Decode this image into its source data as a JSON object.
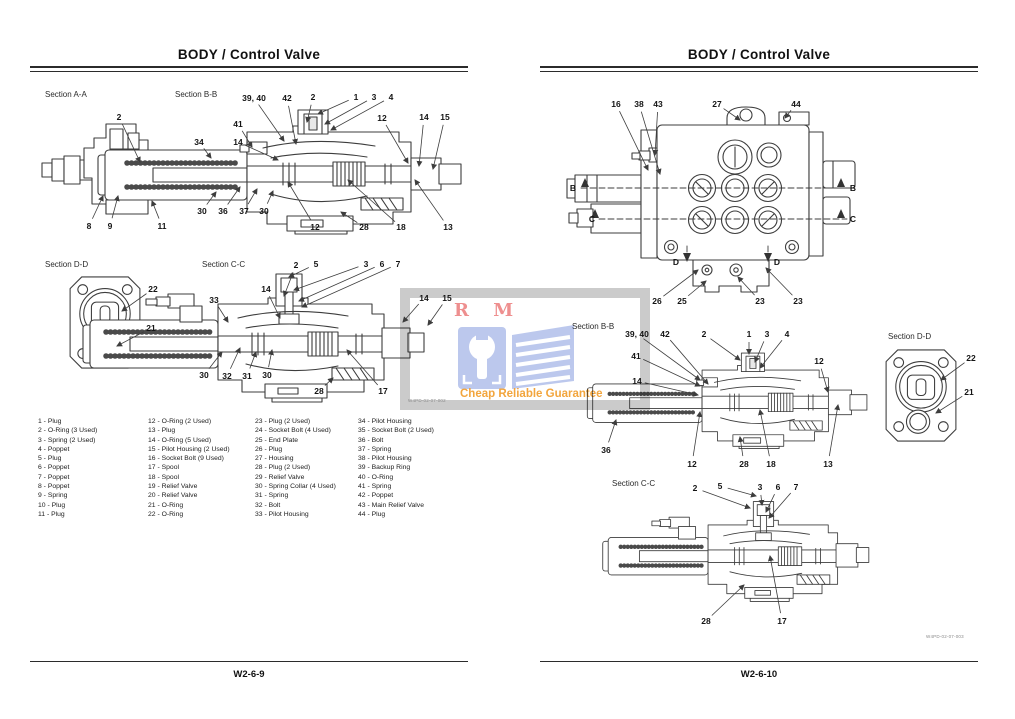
{
  "left_page": {
    "title": "BODY / Control Valve",
    "page_number": "W2-6-9",
    "drawing_number": "W4PD-02-07-002"
  },
  "right_page": {
    "title": "BODY / Control Valve",
    "page_number": "W2-6-10",
    "drawing_number": "W4PD-02-07-003"
  },
  "watermark": {
    "brand": "R M",
    "tagline": "Cheap Reliable Guarantee",
    "colors": {
      "brand_red": "#ee8f8f",
      "logo_blue": "#bcc8ed",
      "tagline_orange": "#f2a53d",
      "frame_gray": "#cbcbcb"
    }
  },
  "parts_list": {
    "columns": [
      [
        "1 - Plug",
        "2 - O-Ring (3 Used)",
        "3 - Spring (2 Used)",
        "4 - Poppet",
        "5 - Plug",
        "6 - Poppet",
        "7 - Poppet",
        "8 - Poppet",
        "9 - Spring",
        "10 - Plug",
        "11 - Plug"
      ],
      [
        "12 - O-Ring (2 Used)",
        "13 - Plug",
        "14 - O-Ring (5 Used)",
        "15 - Pilot Housing (2 Used)",
        "16 - Socket Bolt (9 Used)",
        "17 - Spool",
        "18 - Spool",
        "19 - Relief Valve",
        "20 - Relief Valve",
        "21 - O-Ring",
        "22 - O-Ring"
      ],
      [
        "23 - Plug (2 Used)",
        "24 - Socket Bolt (4 Used)",
        "25 - End Plate",
        "26 - Plug",
        "27 - Housing",
        "28 - Plug (2 Used)",
        "29 - Relief Valve",
        "30 - Spring Collar (4 Used)",
        "31 - Spring",
        "32 - Bolt",
        "33 - Pilot Housing"
      ],
      [
        "34 - Pilot Housing",
        "35 - Socket Bolt (2 Used)",
        "36 - Bolt",
        "37 - Spring",
        "38 - Pilot Housing",
        "39 - Backup Ring",
        "40 - O-Ring",
        "41 - Spring",
        "42 - Poppet",
        "43 - Main Relief Valve",
        "44 - Plug"
      ]
    ]
  },
  "diagrams": [
    {
      "name": "section-aa-left",
      "label": "Section A-A",
      "label_x": 45,
      "label_y": 90,
      "callouts": [
        {
          "t": "2",
          "x": 119,
          "y": 117,
          "lx": 140,
          "ly": 162
        },
        {
          "t": "8",
          "x": 89,
          "y": 226,
          "lx": 103,
          "ly": 196
        },
        {
          "t": "9",
          "x": 110,
          "y": 226,
          "lx": 118,
          "ly": 196
        },
        {
          "t": "11",
          "x": 162,
          "y": 226,
          "lx": 152,
          "ly": 201
        }
      ]
    },
    {
      "name": "section-bb-left",
      "label": "Section B-B",
      "label_x": 175,
      "label_y": 90,
      "callouts": [
        {
          "t": "39, 40",
          "x": 254,
          "y": 98,
          "lx": 284,
          "ly": 141
        },
        {
          "t": "42",
          "x": 287,
          "y": 98,
          "lx": 296,
          "ly": 144
        },
        {
          "t": "2",
          "x": 313,
          "y": 97,
          "lx": 307,
          "ly": 122
        },
        {
          "t": "1",
          "x": 356,
          "y": 97,
          "lx": 318,
          "ly": 114
        },
        {
          "t": "3",
          "x": 374,
          "y": 97,
          "lx": 325,
          "ly": 124
        },
        {
          "t": "4",
          "x": 391,
          "y": 97,
          "lx": 331,
          "ly": 130
        },
        {
          "t": "12",
          "x": 382,
          "y": 118,
          "lx": 408,
          "ly": 163
        },
        {
          "t": "14",
          "x": 424,
          "y": 117,
          "lx": 419,
          "ly": 166
        },
        {
          "t": "15",
          "x": 445,
          "y": 117,
          "lx": 433,
          "ly": 169
        },
        {
          "t": "41",
          "x": 238,
          "y": 124,
          "lx": 252,
          "ly": 147
        },
        {
          "t": "34",
          "x": 199,
          "y": 142,
          "lx": 211,
          "ly": 158
        },
        {
          "t": "14",
          "x": 238,
          "y": 142,
          "lx": 278,
          "ly": 160
        },
        {
          "t": "30",
          "x": 202,
          "y": 211,
          "lx": 216,
          "ly": 192
        },
        {
          "t": "36",
          "x": 223,
          "y": 211,
          "lx": 240,
          "ly": 187
        },
        {
          "t": "37",
          "x": 244,
          "y": 211,
          "lx": 257,
          "ly": 189
        },
        {
          "t": "30",
          "x": 264,
          "y": 211,
          "lx": 273,
          "ly": 191
        },
        {
          "t": "12",
          "x": 315,
          "y": 227,
          "lx": 288,
          "ly": 182
        },
        {
          "t": "28",
          "x": 364,
          "y": 227,
          "lx": 341,
          "ly": 212
        },
        {
          "t": "18",
          "x": 401,
          "y": 227,
          "lx": 348,
          "ly": 180
        },
        {
          "t": "13",
          "x": 448,
          "y": 227,
          "lx": 415,
          "ly": 180
        }
      ]
    },
    {
      "name": "section-dd-left",
      "label": "Section D-D",
      "label_x": 45,
      "label_y": 260,
      "callouts": [
        {
          "t": "22",
          "x": 153,
          "y": 289,
          "lx": 122,
          "ly": 311
        },
        {
          "t": "21",
          "x": 151,
          "y": 328,
          "lx": 117,
          "ly": 346
        }
      ]
    },
    {
      "name": "section-cc-left",
      "label": "Section C-C",
      "label_x": 202,
      "label_y": 260,
      "callouts": [
        {
          "t": "2",
          "x": 296,
          "y": 265,
          "lx": 284,
          "ly": 296
        },
        {
          "t": "5",
          "x": 316,
          "y": 264,
          "lx": 289,
          "ly": 277
        },
        {
          "t": "3",
          "x": 366,
          "y": 264,
          "lx": 294,
          "ly": 290
        },
        {
          "t": "6",
          "x": 382,
          "y": 264,
          "lx": 299,
          "ly": 301
        },
        {
          "t": "7",
          "x": 398,
          "y": 264,
          "lx": 302,
          "ly": 307
        },
        {
          "t": "14",
          "x": 266,
          "y": 289,
          "lx": 280,
          "ly": 318
        },
        {
          "t": "33",
          "x": 214,
          "y": 300,
          "lx": 228,
          "ly": 322
        },
        {
          "t": "14",
          "x": 424,
          "y": 298,
          "lx": 403,
          "ly": 322
        },
        {
          "t": "15",
          "x": 447,
          "y": 298,
          "lx": 428,
          "ly": 325
        },
        {
          "t": "30",
          "x": 204,
          "y": 375,
          "lx": 222,
          "ly": 352
        },
        {
          "t": "32",
          "x": 227,
          "y": 376,
          "lx": 240,
          "ly": 348
        },
        {
          "t": "31",
          "x": 247,
          "y": 376,
          "lx": 256,
          "ly": 352
        },
        {
          "t": "30",
          "x": 267,
          "y": 375,
          "lx": 272,
          "ly": 350
        },
        {
          "t": "28",
          "x": 319,
          "y": 391,
          "lx": 333,
          "ly": 378
        },
        {
          "t": "17",
          "x": 383,
          "y": 391,
          "lx": 347,
          "ly": 350
        }
      ]
    },
    {
      "name": "external-view-right",
      "label": "",
      "label_x": 0,
      "label_y": 0,
      "callouts": [
        {
          "t": "16",
          "x": 616,
          "y": 104,
          "lx": 648,
          "ly": 170
        },
        {
          "t": "38",
          "x": 639,
          "y": 104,
          "lx": 660,
          "ly": 174
        },
        {
          "t": "43",
          "x": 658,
          "y": 104,
          "lx": 655,
          "ly": 155
        },
        {
          "t": "27",
          "x": 717,
          "y": 104,
          "lx": 740,
          "ly": 120
        },
        {
          "t": "44",
          "x": 796,
          "y": 104,
          "lx": 785,
          "ly": 118
        },
        {
          "t": "B",
          "x": 573,
          "y": 188
        },
        {
          "t": "B",
          "x": 853,
          "y": 188
        },
        {
          "t": "C",
          "x": 592,
          "y": 219
        },
        {
          "t": "C",
          "x": 853,
          "y": 219
        },
        {
          "t": "D",
          "x": 676,
          "y": 262
        },
        {
          "t": "D",
          "x": 777,
          "y": 262
        },
        {
          "t": "26",
          "x": 657,
          "y": 301,
          "lx": 698,
          "ly": 270
        },
        {
          "t": "25",
          "x": 682,
          "y": 301,
          "lx": 706,
          "ly": 281
        },
        {
          "t": "23",
          "x": 760,
          "y": 301,
          "lx": 738,
          "ly": 277
        },
        {
          "t": "23",
          "x": 798,
          "y": 301,
          "lx": 766,
          "ly": 268
        }
      ]
    },
    {
      "name": "section-bb-right",
      "label": "Section B-B",
      "label_x": 572,
      "label_y": 322,
      "callouts": [
        {
          "t": "39, 40",
          "x": 637,
          "y": 334,
          "lx": 700,
          "ly": 380
        },
        {
          "t": "42",
          "x": 665,
          "y": 334,
          "lx": 708,
          "ly": 384
        },
        {
          "t": "2",
          "x": 704,
          "y": 334,
          "lx": 740,
          "ly": 360
        },
        {
          "t": "1",
          "x": 749,
          "y": 334,
          "lx": 749,
          "ly": 354
        },
        {
          "t": "3",
          "x": 767,
          "y": 334,
          "lx": 755,
          "ly": 362
        },
        {
          "t": "4",
          "x": 787,
          "y": 334,
          "lx": 760,
          "ly": 368
        },
        {
          "t": "41",
          "x": 636,
          "y": 356,
          "lx": 700,
          "ly": 386
        },
        {
          "t": "14",
          "x": 637,
          "y": 381,
          "lx": 698,
          "ly": 395
        },
        {
          "t": "12",
          "x": 819,
          "y": 361,
          "lx": 828,
          "ly": 392
        },
        {
          "t": "36",
          "x": 606,
          "y": 450,
          "lx": 616,
          "ly": 420
        },
        {
          "t": "12",
          "x": 692,
          "y": 464,
          "lx": 700,
          "ly": 412
        },
        {
          "t": "28",
          "x": 744,
          "y": 464,
          "lx": 740,
          "ly": 437
        },
        {
          "t": "18",
          "x": 771,
          "y": 464,
          "lx": 760,
          "ly": 410
        },
        {
          "t": "13",
          "x": 828,
          "y": 464,
          "lx": 838,
          "ly": 405
        }
      ]
    },
    {
      "name": "section-dd-right",
      "label": "Section D-D",
      "label_x": 888,
      "label_y": 332,
      "callouts": [
        {
          "t": "22",
          "x": 971,
          "y": 358,
          "lx": 941,
          "ly": 380
        },
        {
          "t": "21",
          "x": 969,
          "y": 392,
          "lx": 936,
          "ly": 413
        }
      ]
    },
    {
      "name": "section-cc-right",
      "label": "Section C-C",
      "label_x": 612,
      "label_y": 479,
      "callouts": [
        {
          "t": "2",
          "x": 695,
          "y": 488,
          "lx": 750,
          "ly": 508
        },
        {
          "t": "5",
          "x": 720,
          "y": 486,
          "lx": 756,
          "ly": 496
        },
        {
          "t": "3",
          "x": 760,
          "y": 487,
          "lx": 762,
          "ly": 505
        },
        {
          "t": "6",
          "x": 778,
          "y": 487,
          "lx": 766,
          "ly": 512
        },
        {
          "t": "7",
          "x": 796,
          "y": 487,
          "lx": 769,
          "ly": 518
        },
        {
          "t": "28",
          "x": 706,
          "y": 621,
          "lx": 744,
          "ly": 585
        },
        {
          "t": "17",
          "x": 782,
          "y": 621,
          "lx": 770,
          "ly": 556
        }
      ]
    }
  ]
}
